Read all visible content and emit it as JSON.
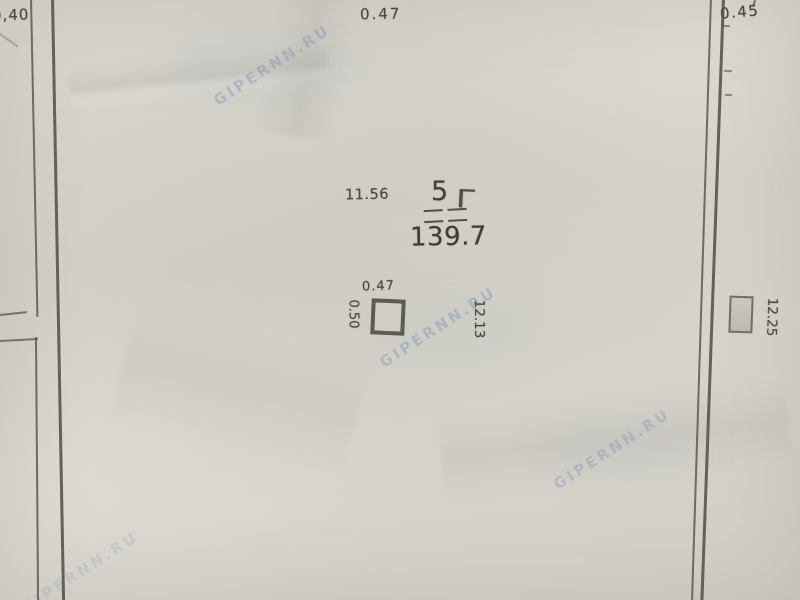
{
  "dimensions": {
    "top_left": "0,40",
    "top_center": "0.47",
    "top_right": "0.45",
    "room_side": "11.56",
    "column_width": "0.47",
    "column_depth": "0.50",
    "interior_width": "12.13",
    "exterior_width": "12.25"
  },
  "room": {
    "number": "5",
    "area": "139.7",
    "handwritten_mark": "Г"
  },
  "watermark": {
    "text": "GIPERNN.RU"
  },
  "colors": {
    "paper": "#d6d2cb",
    "pencil_line": "#605b53",
    "ink": "#46423c",
    "watermark": "#7694ac"
  }
}
